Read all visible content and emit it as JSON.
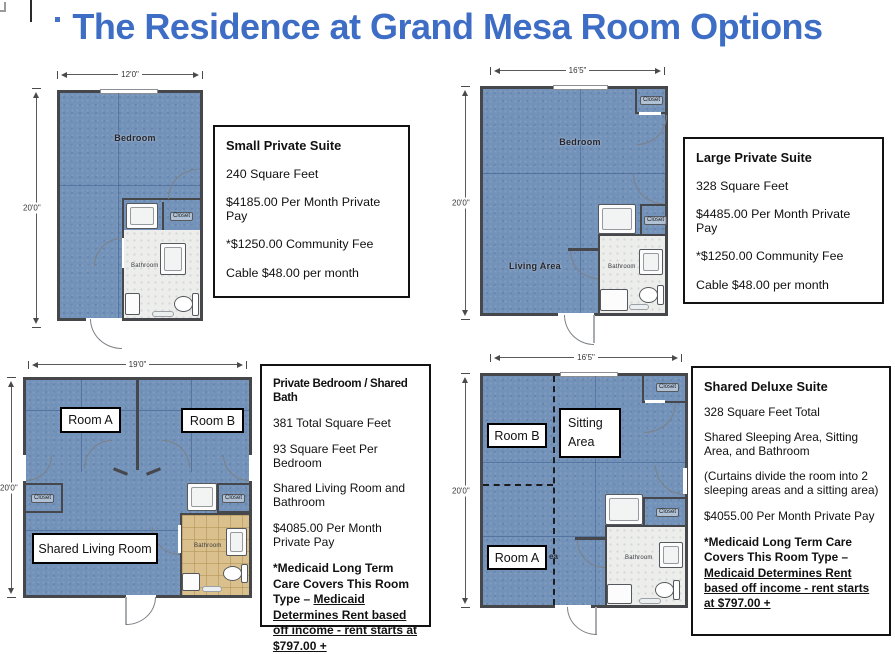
{
  "page": {
    "title": "The Residence at Grand Mesa Room Options"
  },
  "colors": {
    "title_blue": "#3d6dc5",
    "floor_blue": "#7392b9",
    "wall_gray": "#46474a",
    "bath_tan": "#d9c08c"
  },
  "plans": [
    {
      "name": "Small Private Suite",
      "width_label": "12'0\"",
      "height_label": "20'0\"",
      "labels": {
        "bedroom": "Bedroom",
        "closet": "Closet",
        "bathroom": "Bathroom"
      }
    },
    {
      "name": "Large Private Suite",
      "width_label": "16'5\"",
      "height_label": "20'0\"",
      "labels": {
        "bedroom": "Bedroom",
        "living_area": "Living Area",
        "closet_top": "Closet",
        "closet_mid": "Closet",
        "bathroom": "Bathroom"
      }
    },
    {
      "name": "Private Bedroom / Shared Bath",
      "width_label": "19'0\"",
      "height_label": "20'0\"",
      "labels": {
        "room_a": "Room A",
        "room_b": "Room B",
        "shared_living_room": "Shared Living Room",
        "closet_left": "Closet",
        "closet_right": "Closet",
        "bathroom": "Bathroom"
      }
    },
    {
      "name": "Shared Deluxe Suite",
      "width_label": "16'5\"",
      "height_label": "20'0\"",
      "labels": {
        "room_a": "Room A",
        "room_b": "Room B",
        "sitting_line1": "Sitting",
        "sitting_line2": "Area",
        "area_fragment": "ea",
        "closet_top": "Closet",
        "closet_mid": "Closet",
        "bathroom": "Bathroom"
      }
    }
  ],
  "info_boxes": [
    {
      "title": "Small Private Suite",
      "lines": [
        "240 Square Feet",
        "$4185.00 Per Month Private Pay",
        "*$1250.00 Community Fee",
        "Cable $48.00 per month"
      ]
    },
    {
      "title": "Large Private Suite",
      "lines": [
        "328 Square Feet",
        "$4485.00 Per Month Private Pay",
        "*$1250.00 Community Fee",
        "Cable $48.00 per month"
      ]
    },
    {
      "title": "Private Bedroom / Shared Bath",
      "lines": [
        "381 Total Square Feet",
        "93 Square Feet Per Bedroom",
        "Shared Living Room and Bathroom",
        "$4085.00 Per Month Private Pay"
      ],
      "note_bold": "*Medicaid Long Term Care Covers This Room Type – ",
      "note_underlined": "Medicaid Determines Rent based off income - rent starts at $797.00 +"
    },
    {
      "title": "Shared Deluxe Suite",
      "lines": [
        "328 Square Feet Total",
        "Shared Sleeping Area, Sitting Area, and Bathroom",
        "(Curtains divide the room into 2 sleeping areas and a sitting area)",
        "$4055.00 Per Month Private Pay"
      ],
      "note_bold": "*Medicaid Long Term Care Covers This Room Type – ",
      "note_underlined": "Medicaid Determines Rent based off income - rent starts at $797.00 +"
    }
  ]
}
